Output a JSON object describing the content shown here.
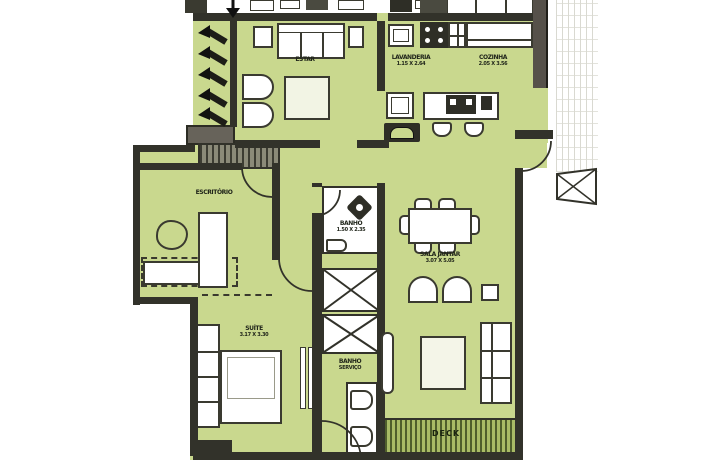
{
  "title": "apartment-floor-plan",
  "colors": {
    "floor_green": "#c9d88e",
    "wall_dark": "#32322a",
    "wall_brown": "#56514a",
    "landing_gray": "#67635a",
    "deck_line": "#4f5e2c",
    "paper_white": "#ffffff"
  },
  "rooms": {
    "living": {
      "label": "ESTAR"
    },
    "laundry": {
      "label": "LAVANDERIA",
      "dims": "1.15 X 2.64"
    },
    "kitchen": {
      "label": "COZINHA",
      "dims": "2.05 X 3.56"
    },
    "office": {
      "label": "ESCRITÓRIO"
    },
    "bath": {
      "label": "BANHO",
      "dims": "1.50 X 2.35"
    },
    "dining": {
      "label": "SALA JANTAR",
      "dims": "3.07 X 5.05"
    },
    "service_wc": {
      "label": "BANHO",
      "dims": "SERVIÇO"
    },
    "suite": {
      "label": "SUÍTE",
      "dims": "3.17 X 3.30"
    },
    "deck": {
      "label": "DECK"
    }
  }
}
